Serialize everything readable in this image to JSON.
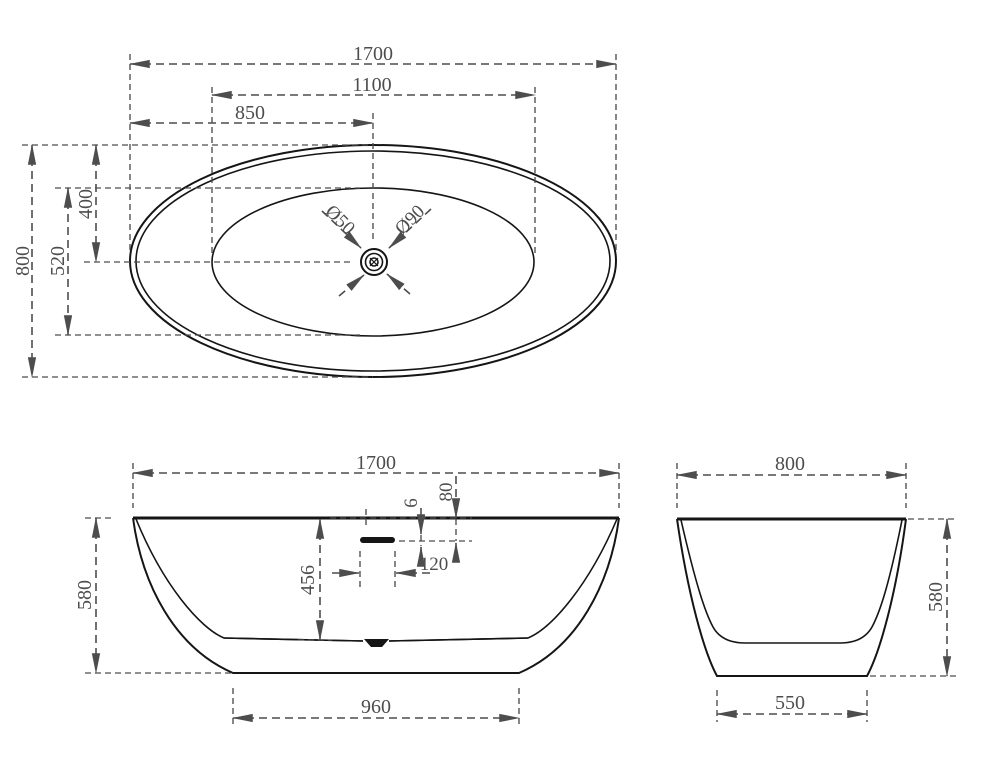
{
  "drawing": {
    "title": "Freestanding oval bathtub dimension drawing",
    "colors": {
      "object_line": "#151515",
      "dimension": "#4d4d4d",
      "background": "#ffffff"
    },
    "views": {
      "top": {
        "name": "top view (plan)",
        "dims": {
          "overall_length": "1700",
          "inner_length": "1100",
          "center_length": "850",
          "overall_width": "800",
          "center_width": "400",
          "inner_width": "520",
          "drain_diameter_small": "Ø50",
          "drain_diameter_large": "Ø90"
        }
      },
      "front": {
        "name": "front view (elevation)",
        "dims": {
          "overall_length": "1700",
          "rim_to_overflow": "80",
          "overflow_slot_height": "6",
          "overflow_width": "120",
          "inner_depth": "456",
          "overall_height": "580",
          "base_length": "960"
        }
      },
      "side": {
        "name": "side view (end elevation)",
        "dims": {
          "overall_width": "800",
          "overall_height": "580",
          "base_width": "550"
        }
      }
    }
  }
}
